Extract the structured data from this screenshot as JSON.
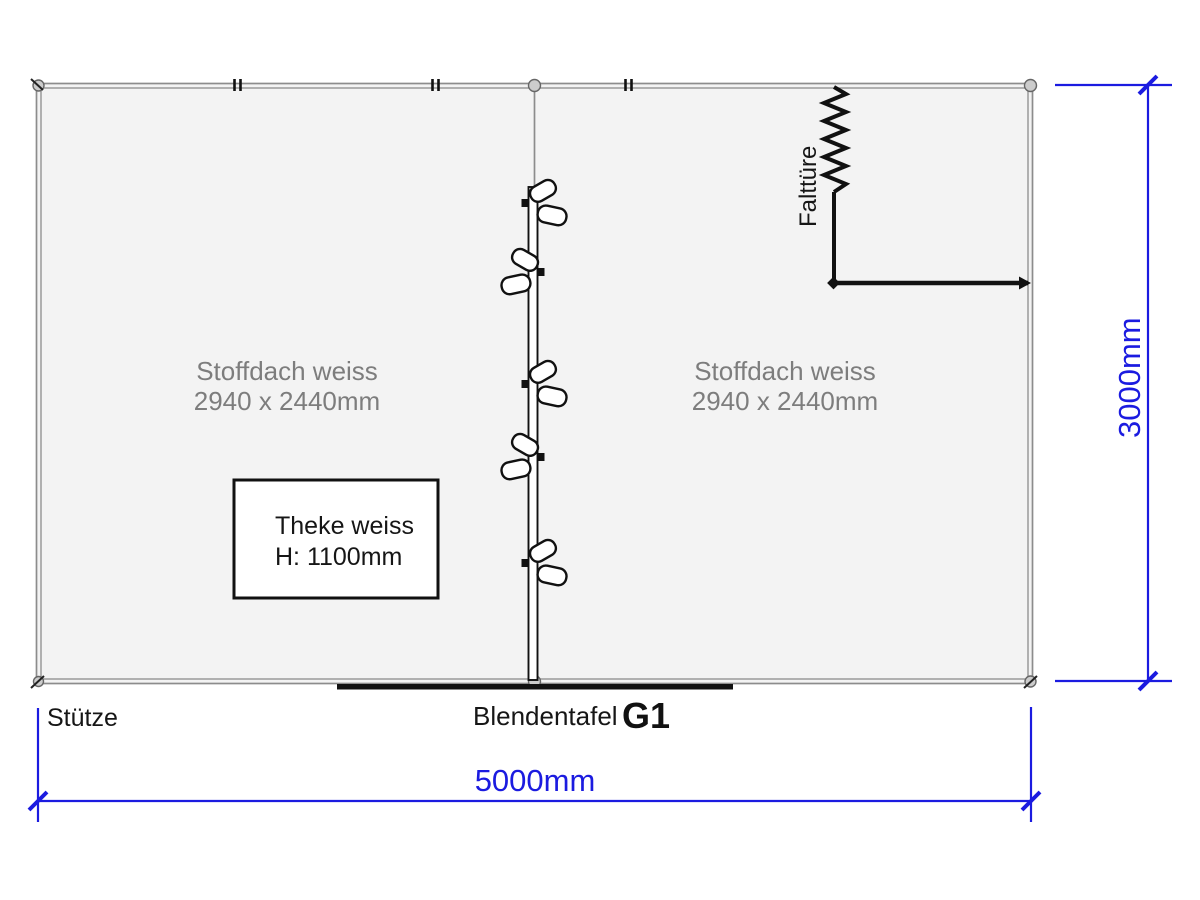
{
  "plan": {
    "roof_panel_left": {
      "name": "Stoffdach weiss",
      "size": "2940 x 2440mm"
    },
    "roof_panel_right": {
      "name": "Stoffdach weiss",
      "size": "2940 x 2440mm"
    },
    "counter": {
      "name": "Theke weiss",
      "height": "H: 1100mm"
    },
    "folding_door_label": "Falttüre",
    "support_label": "Stütze",
    "fascia_label": "Blendentafel",
    "graphic_id": "G1"
  },
  "dimensions": {
    "width_label": "5000mm",
    "depth_label": "3000mm"
  },
  "colors": {
    "dimension_blue": "#1b1be0",
    "wall_gray": "#8c8c8c",
    "floor_fill": "#f3f3f3",
    "label_gray": "#7d7d7d",
    "line_black": "#111111"
  }
}
